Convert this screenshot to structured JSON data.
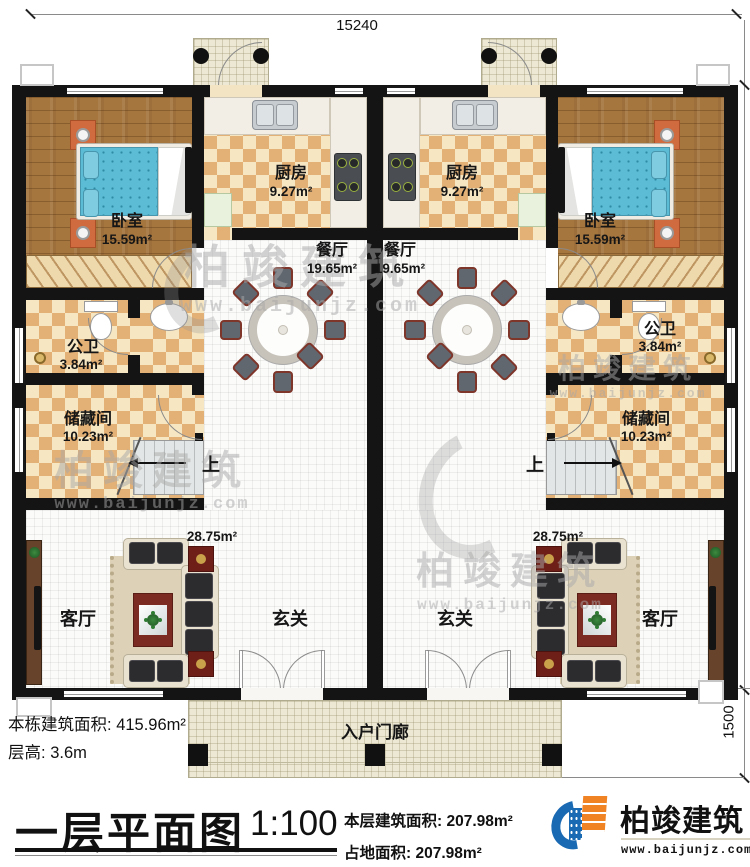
{
  "dimensions": {
    "width": "15240",
    "depth": "13000",
    "porch_depth": "1500"
  },
  "rooms": {
    "bedroom": {
      "label": "卧室",
      "area": "15.59m²"
    },
    "kitchen": {
      "label": "厨房",
      "area": "9.27m²"
    },
    "dining": {
      "label": "餐厅",
      "area": "19.65m²"
    },
    "bathroom": {
      "label": "公卫",
      "area": "3.84m²"
    },
    "storage": {
      "label": "储藏间",
      "area": "10.23m²"
    },
    "living": {
      "label": "客厅",
      "area": "28.75m²"
    },
    "foyer": {
      "label": "玄关"
    },
    "stairs": {
      "label": "上"
    },
    "entry_porch": {
      "label": "入户门廊"
    }
  },
  "info": {
    "building_area_label": "本栋建筑面积:",
    "building_area_value": "415.96m²",
    "floor_height_label": "层高:",
    "floor_height_value": "3.6m"
  },
  "title_block": {
    "plan_title": "一层平面图",
    "scale": "1:100",
    "floor_area_label": "本层建筑面积:",
    "floor_area_value": "207.98m²",
    "footprint_label": "占地面积:",
    "footprint_value": "207.98m²"
  },
  "brand": {
    "name": "柏竣建筑",
    "website": "www.baijunjz.com"
  },
  "watermark": {
    "text": "柏竣建筑",
    "url": "www.baijunjz.com"
  },
  "colors": {
    "accent_blue": "#1a6ab3",
    "accent_orange": "#f08425",
    "wall": "#141414"
  }
}
